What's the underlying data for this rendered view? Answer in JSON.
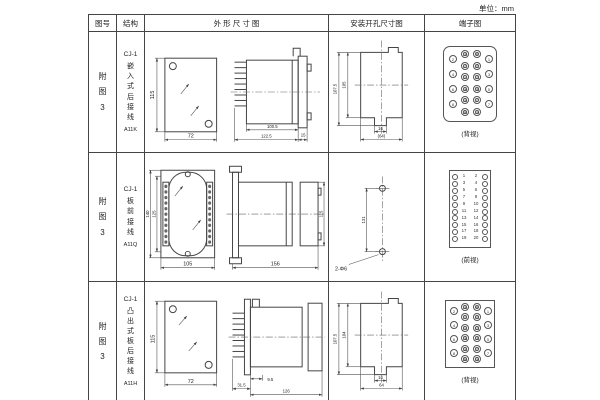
{
  "unit_label": "单位：mm",
  "headers": {
    "fig": "图号",
    "struct": "结构",
    "outline": "外 形 尺 寸 图",
    "install": "安装开孔尺寸图",
    "terminal": "端子图"
  },
  "rows": [
    {
      "figure_no": "附\n图\n3",
      "structure": {
        "model": "CJ-1",
        "type": "嵌入式后接线",
        "code": "A11K"
      },
      "outline": {
        "front_h": "115",
        "front_w": "72",
        "body_d": "100.5",
        "total_d": "122.5",
        "flange_d": "15"
      },
      "install": {
        "outer_h": "107.5",
        "inner_h": "105",
        "slot_w": "16",
        "width": "(64)"
      },
      "terminal": {
        "label": "(背视)",
        "box": {
          "w": 52,
          "h": 74,
          "rounded": true
        },
        "cols": [
          {
            "x": 5,
            "y": 8,
            "dy": 15,
            "labels": [
              "2",
              "4",
              "6",
              "8"
            ]
          },
          {
            "x": 17,
            "y": 3,
            "dy": 11.5,
            "double": true,
            "labels": [
              "10",
              "12",
              "14",
              "16",
              "18",
              "20"
            ]
          },
          {
            "x": 29,
            "y": 3,
            "dy": 11.5,
            "double": true,
            "labels": [
              "9",
              "11",
              "13",
              "15",
              "17",
              "19"
            ]
          },
          {
            "x": 41,
            "y": 8,
            "dy": 15,
            "labels": [
              "1",
              "3",
              "5",
              "7"
            ]
          }
        ]
      }
    },
    {
      "figure_no": "附\n图\n3",
      "structure": {
        "model": "CJ-1",
        "type": "板前接线",
        "code": "A11Q"
      },
      "outline": {
        "front_h_outer": "140",
        "front_h_inner": "125",
        "front_w": "105",
        "side_l": "156",
        "side_h": "115"
      },
      "install": {
        "hole_dist": "131",
        "hole_label": "2-Φ6"
      },
      "terminal": {
        "label": "(前视)",
        "box": {
          "w": 40,
          "h": 76
        },
        "left_nums": "1\n3\n5\n7\n9\n11\n13\n15\n17\n19",
        "right_nums": "2\n4\n6\n8\n10\n12\n14\n16\n18\n20",
        "cols": [
          {
            "x": 2,
            "y": 3,
            "dy": 6.9,
            "s": 6,
            "labels": [
              "",
              "",
              "",
              "",
              "",
              "",
              "",
              "",
              "",
              ""
            ]
          },
          {
            "x": 32,
            "y": 3,
            "dy": 6.9,
            "s": 6,
            "labels": [
              "",
              "",
              "",
              "",
              "",
              "",
              "",
              "",
              "",
              ""
            ]
          }
        ]
      }
    },
    {
      "figure_no": "附\n图\n3",
      "structure": {
        "model": "CJ-1",
        "type": "凸出式板后接线",
        "code": "A11H"
      },
      "outline": {
        "front_h": "115",
        "front_w": "72",
        "pin_d": "31.5",
        "plate_d": "9.5",
        "body_d": "126"
      },
      "install": {
        "outer_h": "107.5",
        "inner_h": "104",
        "slot_w": "16",
        "width": "64"
      },
      "terminal": {
        "label": "(背视)",
        "box": {
          "w": 48,
          "h": 66
        },
        "cols": [
          {
            "x": 4,
            "y": 6,
            "dy": 14,
            "labels": [
              "2",
              "4",
              "6",
              "8"
            ]
          },
          {
            "x": 15,
            "y": 2,
            "dy": 10.5,
            "double": true,
            "labels": [
              "10",
              "12",
              "14",
              "16",
              "18",
              "20"
            ]
          },
          {
            "x": 27,
            "y": 2,
            "dy": 10.5,
            "double": true,
            "labels": [
              "9",
              "11",
              "13",
              "15",
              "17",
              "19"
            ]
          },
          {
            "x": 38,
            "y": 6,
            "dy": 14,
            "labels": [
              "1",
              "3",
              "5",
              "7"
            ]
          }
        ]
      }
    }
  ]
}
